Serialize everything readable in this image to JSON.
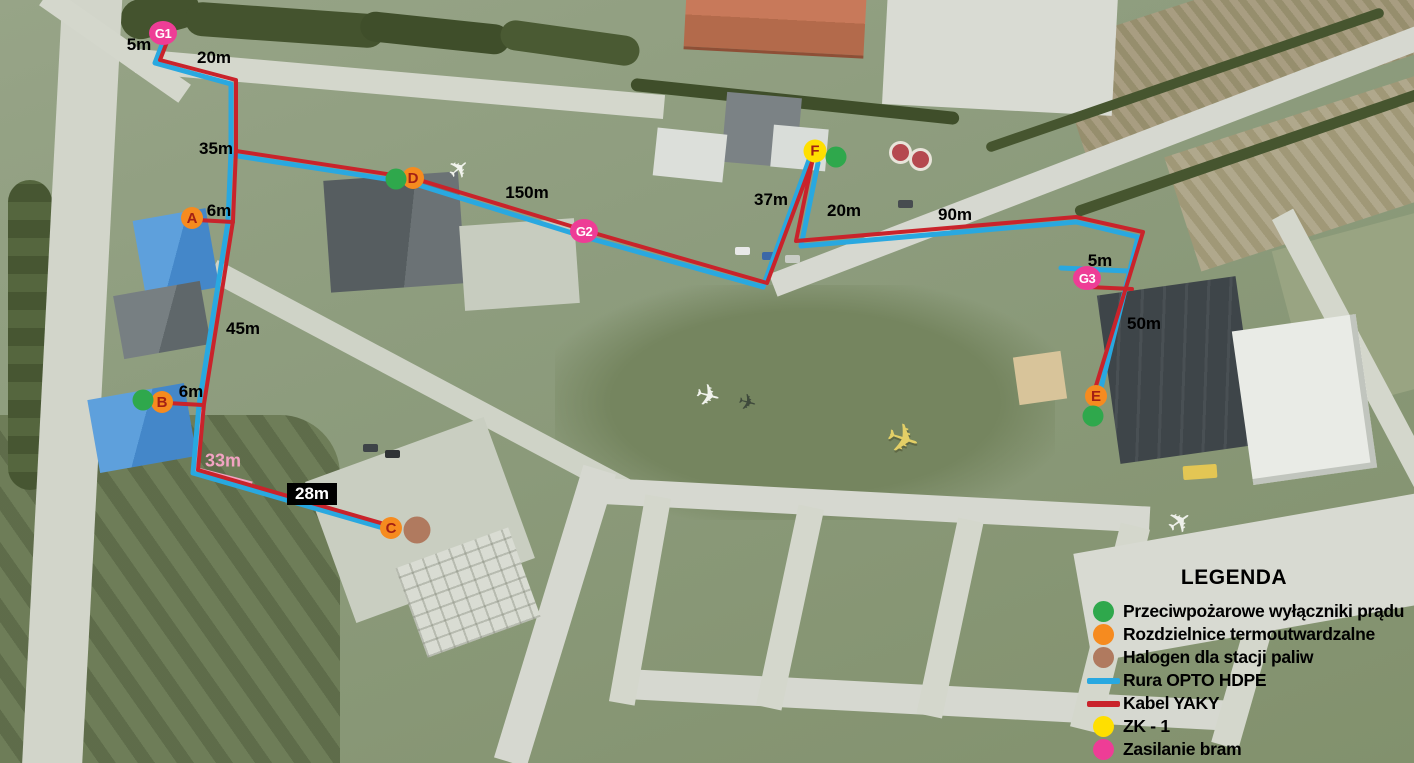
{
  "legend": {
    "title": "LEGENDA",
    "items": [
      {
        "label": "Przeciwpożarowe wyłączniki prądu",
        "swatch": "circle",
        "color": "#2fa84c",
        "icon": "fire-switch-icon"
      },
      {
        "label": "Rozdzielnice termoutwardzalne",
        "swatch": "circle",
        "color": "#f68b1f",
        "icon": "distribution-box-icon"
      },
      {
        "label": "Halogen dla stacji paliw",
        "swatch": "circle",
        "color": "#b07a5f",
        "icon": "halogen-icon"
      },
      {
        "label": "Rura OPTO HDPE",
        "swatch": "line",
        "color": "#29a8e0",
        "icon": "opto-pipe-icon"
      },
      {
        "label": "Kabel YAKY",
        "swatch": "line",
        "color": "#c9232b",
        "icon": "yaky-cable-icon"
      },
      {
        "label": "ZK - 1",
        "swatch": "circle",
        "color": "#ffdf00",
        "icon": "zk1-icon"
      },
      {
        "label": "Zasilanie bram",
        "swatch": "circle",
        "color": "#ee3d96",
        "icon": "gate-power-icon"
      }
    ]
  },
  "colors": {
    "opto_pipe_blue": "#29a8e0",
    "yaky_cable_red": "#c9232b",
    "gate_line_pink": "#f2a3c2",
    "gate_marker_pink": "#ee3d96",
    "node_orange": "#f68b1f",
    "fire_green": "#2fa84c",
    "zk_yellow": "#ffdf00",
    "halogen_brown": "#b07a5f"
  },
  "markers": [
    {
      "label": "G1",
      "type": "gate",
      "name": "marker-gate-G1",
      "x": 163,
      "y": 33
    },
    {
      "label": "G2",
      "type": "gate",
      "name": "marker-gate-G2",
      "x": 584,
      "y": 231
    },
    {
      "label": "G3",
      "type": "gate",
      "name": "marker-gate-G3",
      "x": 1087,
      "y": 278
    },
    {
      "label": "A",
      "type": "node",
      "name": "marker-node-A",
      "x": 192,
      "y": 218
    },
    {
      "label": "B",
      "type": "node",
      "name": "marker-node-B",
      "x": 162,
      "y": 402
    },
    {
      "label": "C",
      "type": "node",
      "name": "marker-node-C",
      "x": 391,
      "y": 528
    },
    {
      "label": "D",
      "type": "node",
      "name": "marker-node-D",
      "x": 413,
      "y": 178
    },
    {
      "label": "E",
      "type": "node",
      "name": "marker-node-E",
      "x": 1096,
      "y": 396
    },
    {
      "label": "F",
      "type": "zk",
      "name": "marker-zk-F",
      "x": 815,
      "y": 151
    },
    {
      "label": "",
      "type": "fire",
      "name": "fire-switch-icon",
      "x": 396,
      "y": 179
    },
    {
      "label": "",
      "type": "fire",
      "name": "fire-switch-icon",
      "x": 836,
      "y": 157
    },
    {
      "label": "",
      "type": "fire",
      "name": "fire-switch-icon",
      "x": 1093,
      "y": 416
    },
    {
      "label": "",
      "type": "fire",
      "name": "fire-switch-icon",
      "x": 143,
      "y": 400
    },
    {
      "label": "",
      "type": "halogen",
      "name": "halogen-icon",
      "x": 417,
      "y": 530
    }
  ],
  "distance_labels": [
    {
      "text": "5m",
      "x": 139,
      "y": 45,
      "variant": ""
    },
    {
      "text": "20m",
      "x": 214,
      "y": 58,
      "variant": ""
    },
    {
      "text": "35m",
      "x": 216,
      "y": 149,
      "variant": ""
    },
    {
      "text": "6m",
      "x": 219,
      "y": 211,
      "variant": ""
    },
    {
      "text": "150m",
      "x": 527,
      "y": 193,
      "variant": ""
    },
    {
      "text": "37m",
      "x": 771,
      "y": 200,
      "variant": ""
    },
    {
      "text": "20m",
      "x": 844,
      "y": 211,
      "variant": ""
    },
    {
      "text": "90m",
      "x": 955,
      "y": 215,
      "variant": ""
    },
    {
      "text": "5m",
      "x": 1100,
      "y": 261,
      "variant": ""
    },
    {
      "text": "50m",
      "x": 1144,
      "y": 324,
      "variant": ""
    },
    {
      "text": "45m",
      "x": 243,
      "y": 329,
      "variant": ""
    },
    {
      "text": "6m",
      "x": 191,
      "y": 392,
      "variant": ""
    },
    {
      "text": "33m",
      "x": 223,
      "y": 461,
      "variant": "pink"
    },
    {
      "text": "28m",
      "x": 312,
      "y": 494,
      "variant": "boxed"
    }
  ]
}
